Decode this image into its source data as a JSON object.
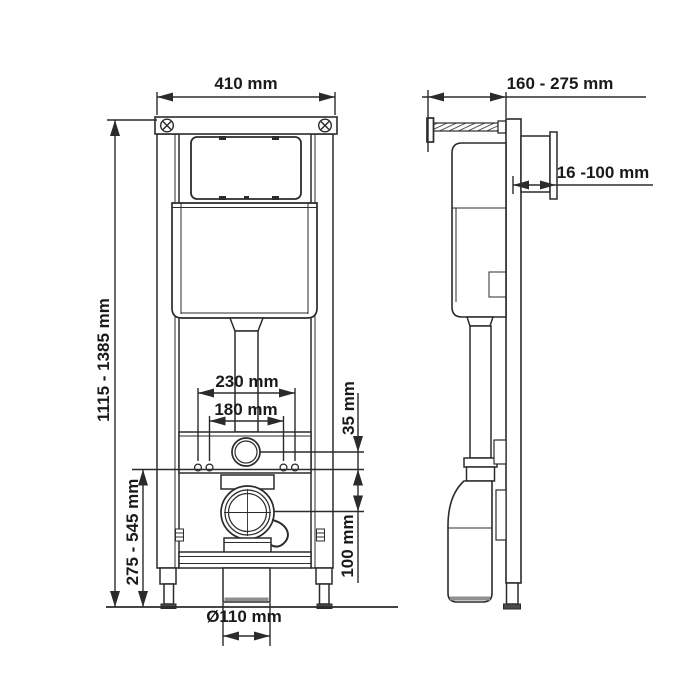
{
  "drawing_title": "WC installation frame technical drawing",
  "colors": {
    "line": "#2b2b2b",
    "text": "#1a1a1a",
    "background": "#ffffff",
    "shade": "#8f8f8f",
    "foot_base": "#4a4a4a"
  },
  "front_view": {
    "width_label": "410 mm",
    "height_label": "1115 - 1385 mm",
    "lower_height_label": "275 - 545 mm",
    "fixing_outer_label": "230 mm",
    "fixing_inner_label": "180 mm",
    "flush_offset_label": "35 mm",
    "outlet_offset_label": "100 mm",
    "outlet_diameter_label": "Ø110 mm"
  },
  "side_view": {
    "depth_label": "160 - 275 mm",
    "wall_distance_label": "16 -100 mm"
  }
}
